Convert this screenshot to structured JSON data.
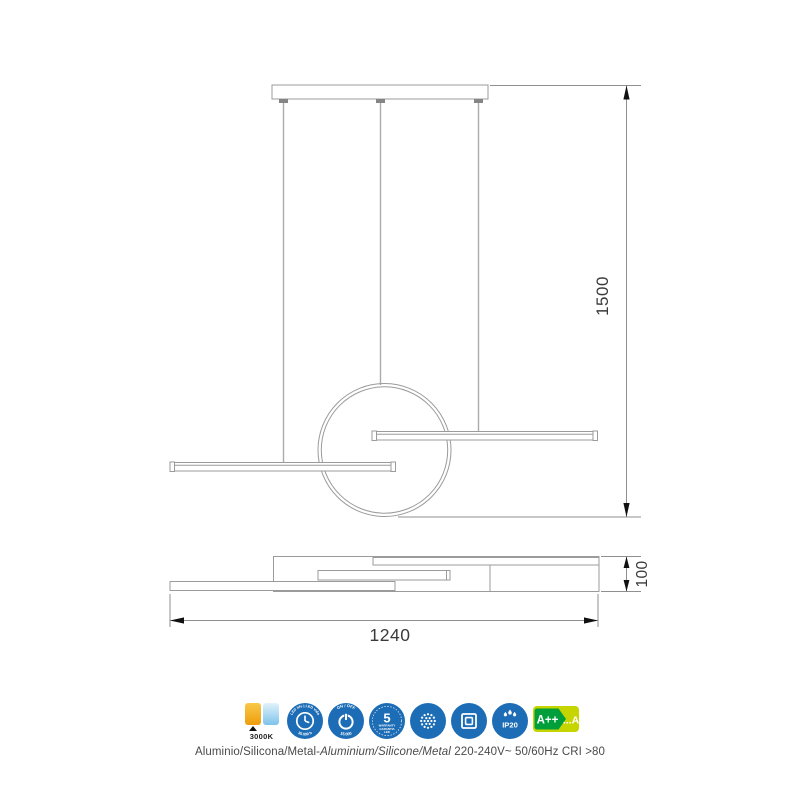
{
  "dims": {
    "height": "1500",
    "width": "1240",
    "depth": "100"
  },
  "icons": {
    "color_temp": {
      "label": "3000K"
    },
    "led_life": {
      "top": "LED life | LED vida",
      "bottom": "35.000 h"
    },
    "on_off": {
      "top": "ON / OFF",
      "bottom": "15.000"
    },
    "warranty": {
      "value": "5",
      "line1": "WARRANTY",
      "line2": "GARANTIA",
      "line3": "LED"
    },
    "ip_rating": {
      "label": "IP20"
    },
    "energy": {
      "best": "A++",
      "range": "...A"
    }
  },
  "caption": {
    "materials_es": "Aluminio/Silicona/Metal-",
    "materials_en": "Aluminium/Silicone/Metal",
    "electrical": " 220-240V~ 50/60Hz CRI >80"
  },
  "colors": {
    "icon_blue": "#1d6db6",
    "energy_background": "#c6d400",
    "energy_arrow_green": "#009f3c",
    "drawing_line": "#9b9b9b",
    "dimension_text": "#3a3a3a",
    "warm_bar": "#ee9d0b",
    "cool_bar": "#7ec3ea"
  }
}
